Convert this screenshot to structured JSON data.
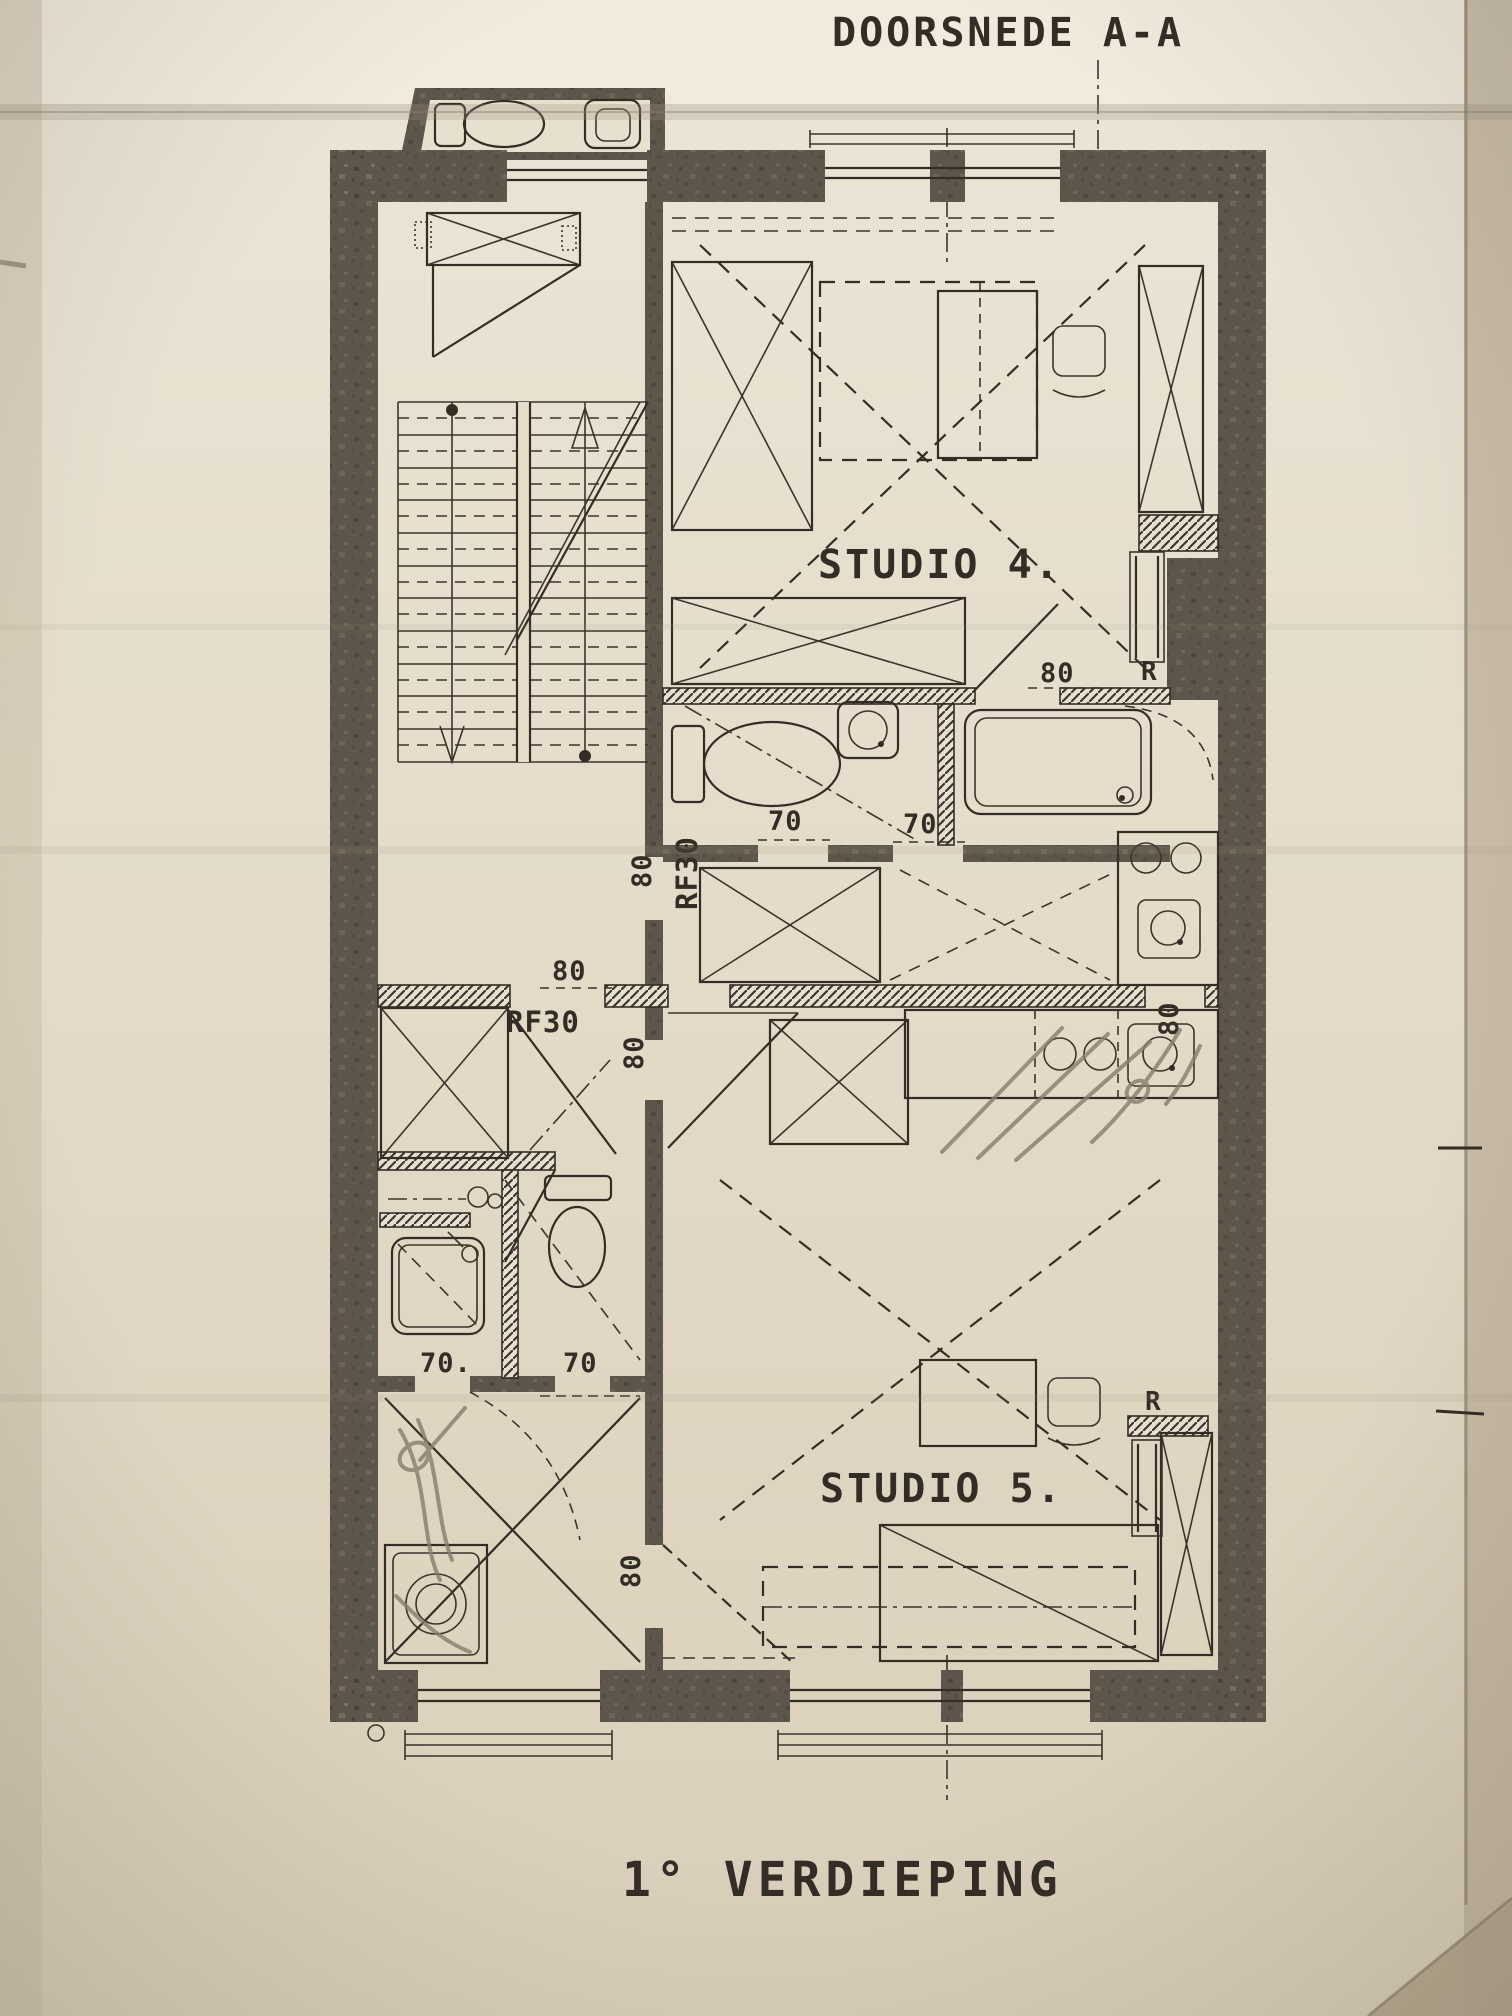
{
  "photo": {
    "kind": "photograph of scanned architectural floor plan",
    "paper_color": "#e4dbc9",
    "ink_color": "#332d25",
    "wall_color": "#5d564a",
    "pencil_color": "#867d6d"
  },
  "title": "DOORSNEDE A-A",
  "floor_caption": "1° VERDIEPING",
  "rooms": {
    "studio4_label": "STUDIO 4.",
    "studio5_label": "STUDIO 5."
  },
  "door_labels": {
    "rf30_vertical": "RF30",
    "rf30_hall": "RF30"
  },
  "appliance_labels": {
    "fridge_studio4": "R",
    "fridge_studio5": "R"
  },
  "dimensions": {
    "d80_studio4_door": "80",
    "d80_spine_door_vertical": "80",
    "d80_hall_closet": "80",
    "d80_hall_lower_vertical": "80",
    "d80_kitchen_pass_vertical": "80",
    "d80_studio5_door_vertical": "80",
    "d70_bath4_left": "70",
    "d70_bath4_right": "70",
    "d70_bath5_left": "70.",
    "d70_bath5_right": "70"
  }
}
